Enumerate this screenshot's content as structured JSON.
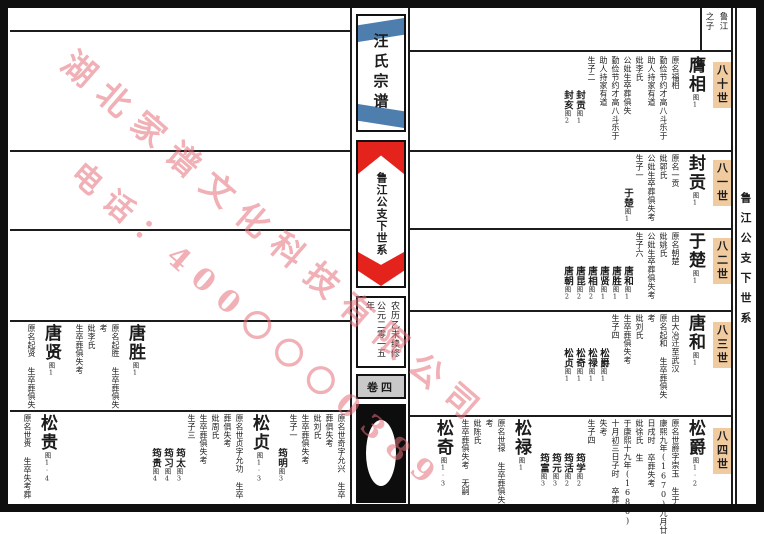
{
  "spine": {
    "title": "汪氏宗谱",
    "subtitle": "鲁江公支下世系",
    "edition_right": "农历乙未续修",
    "edition_left": "公元二零一五年",
    "volume": "卷四"
  },
  "right_margin": {
    "text": "鲁江公支下世系"
  },
  "header": {
    "right": "鲁江",
    "left": "之子"
  },
  "watermark": {
    "line1": "湖北家谱文化科技有限公司",
    "line2": "电话：400〇〇〇0389"
  },
  "generation_highlight_color": "#f0cba0",
  "ribbon_red": "#e3231c",
  "ribbon_blue": "#4d7eae",
  "right_rows": [
    {
      "generation": "八十世",
      "entries": [
        {
          "name": "膺相",
          "ref": "图1",
          "details": [
            "原名福相",
            "勤俭节约才高八斗乐于",
            "助人持家有道",
            "妣李氏",
            "公妣生卒葬俱失",
            "勤俭节约才高八斗乐于",
            "助人持家有道",
            "生子二"
          ],
          "children": [
            {
              "n": "封贡",
              "ref": "图1"
            },
            {
              "n": "封亥",
              "ref": "图2"
            }
          ]
        }
      ]
    },
    {
      "generation": "八一世",
      "entries": [
        {
          "name": "封贡",
          "ref": "图1",
          "details": [
            "原名一贡",
            "妣郭氏",
            "公妣生卒葬俱失考",
            "生子一"
          ],
          "children": [
            {
              "n": "于楚",
              "ref": "图1"
            }
          ]
        }
      ]
    },
    {
      "generation": "八二世",
      "entries": [
        {
          "name": "于楚",
          "ref": "图1",
          "details": [
            "原名朝楚",
            "妣姚氏",
            "公妣生卒葬俱失考",
            "生子六"
          ],
          "children": [
            {
              "n": "唐和",
              "ref": "图1"
            },
            {
              "n": "唐胜",
              "ref": "图1"
            },
            {
              "n": "唐贤",
              "ref": "图1"
            },
            {
              "n": "唐相",
              "ref": "图2"
            },
            {
              "n": "唐昆",
              "ref": "图2"
            },
            {
              "n": "唐朝",
              "ref": "图2"
            }
          ]
        }
      ]
    },
    {
      "generation": "八三世",
      "entries": [
        {
          "name": "唐和",
          "ref": "图1",
          "details": [
            "由大冶迁至武汉",
            "原名起和 生卒葬俱失",
            "考",
            "妣刘氏",
            "生卒葬俱失考",
            "生子四"
          ],
          "children": [
            {
              "n": "松爵",
              "ref": "图1"
            },
            {
              "n": "松禄",
              "ref": "图1"
            },
            {
              "n": "松奇",
              "ref": "图1"
            },
            {
              "n": "松贞",
              "ref": "图1"
            }
          ]
        }
      ]
    },
    {
      "generation": "八四世",
      "entries": [
        {
          "name": "松爵",
          "ref": "图1·2",
          "details": [
            "原名世爵字崇玉 生于",
            "康熙九年(1670)九月廿",
            "日戌时 卒葬失考",
            "妣徐氏 生",
            "于康熙十九年(1680)",
            "十月初三日子时 卒葬",
            "失考",
            "生子四"
          ],
          "children": [
            {
              "n": "筠学",
              "ref": "图2"
            },
            {
              "n": "筠活",
              "ref": "图2"
            },
            {
              "n": "筠元",
              "ref": "图3"
            },
            {
              "n": "筠富",
              "ref": "图3"
            }
          ]
        },
        {
          "name": "松禄",
          "ref": "图1",
          "details": [
            "原名世禄 生卒葬俱失",
            "考",
            "妣陈氏",
            "生卒葬俱失考 无嗣"
          ],
          "children": []
        },
        {
          "name": "松奇",
          "ref": "图1·3",
          "details": [],
          "children": []
        }
      ]
    }
  ],
  "left_rows": [
    {
      "entries": [
        {
          "spacer": 200
        },
        {
          "name": "唐胜",
          "ref": "图1",
          "details": [
            "原名起胜 生卒葬俱失",
            "考",
            "妣李氏",
            "生卒葬俱失考"
          ],
          "children": []
        },
        {
          "spacer": 6
        },
        {
          "name": "唐贤",
          "ref": "图1",
          "details": [
            "原名起贤 生卒葬俱失"
          ],
          "children": []
        }
      ]
    },
    {
      "entries": [
        {
          "name": "",
          "ref": "",
          "details": [
            "原名世奇字允兴 生卒",
            "葬俱失考",
            "妣刘氏",
            "生卒葬俱失考",
            "生子一"
          ],
          "children": [
            {
              "n": "筠明",
              "ref": "图3"
            }
          ]
        },
        {
          "name": "松贞",
          "ref": "图1·3",
          "details": [
            "原名世贞字允功 生卒",
            "葬俱失考",
            "妣周氏",
            "生卒葬俱失考",
            "生子三"
          ],
          "children": [
            {
              "n": "筠太",
              "ref": "图3"
            },
            {
              "n": "筠习",
              "ref": "图4"
            },
            {
              "n": "筠贵",
              "ref": "图4"
            }
          ]
        },
        {
          "spacer": 86
        },
        {
          "name": "松贵",
          "ref": "图1·4",
          "details": [
            "原名世贵 生卒失考葬"
          ],
          "children": []
        }
      ]
    }
  ]
}
